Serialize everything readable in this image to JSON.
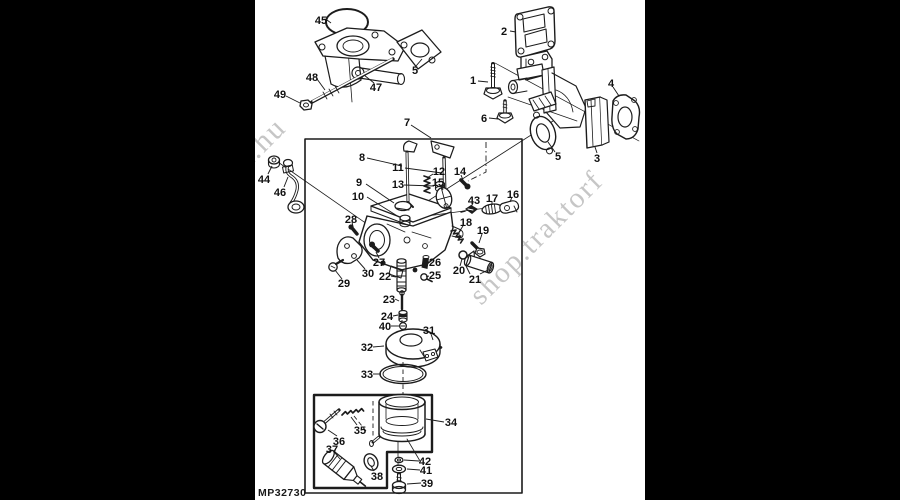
{
  "colors": {
    "letterbox": "#000000",
    "paper": "#ffffff",
    "ink": "#1c1c1c",
    "watermark": "#c6c6c6",
    "label_text": "#101010"
  },
  "footer": {
    "code": "MP32730"
  },
  "watermarks": [
    {
      "text": "k.hu",
      "x": -10,
      "y": 172,
      "rotate": -45,
      "size": 30
    },
    {
      "text": "shop.traktorf",
      "x": 226,
      "y": 306,
      "rotate": -45,
      "size": 29
    }
  ],
  "diagram": {
    "kind": "exploded-parts-diagram",
    "subject": "carburetor and intake manifold",
    "parts": [
      {
        "id": "45",
        "label": "45",
        "x": 66,
        "y": 20,
        "leaders": [
          [
            72,
            20,
            76,
            23
          ]
        ]
      },
      {
        "id": "48",
        "label": "48",
        "x": 57,
        "y": 77,
        "leaders": [
          [
            62,
            79,
            70,
            90
          ]
        ]
      },
      {
        "id": "49",
        "label": "49",
        "x": 25,
        "y": 94,
        "leaders": [
          [
            31,
            96,
            45,
            103
          ]
        ]
      },
      {
        "id": "47",
        "label": "47",
        "x": 121,
        "y": 87,
        "leaders": [
          [
            119,
            83,
            109,
            75
          ]
        ]
      },
      {
        "id": "5a",
        "label": "5",
        "x": 160,
        "y": 70,
        "leaders": [
          [
            161,
            66,
            167,
            59
          ]
        ]
      },
      {
        "id": "7",
        "label": "7",
        "x": 152,
        "y": 122,
        "leaders": [
          [
            156,
            125,
            176,
            138
          ]
        ]
      },
      {
        "id": "2",
        "label": "2",
        "x": 249,
        "y": 31,
        "leaders": [
          [
            255,
            31,
            261,
            32
          ]
        ]
      },
      {
        "id": "1",
        "label": "1",
        "x": 218,
        "y": 80,
        "leaders": [
          [
            223,
            81,
            233,
            82
          ]
        ]
      },
      {
        "id": "6",
        "label": "6",
        "x": 229,
        "y": 118,
        "leaders": [
          [
            234,
            118,
            243,
            119
          ]
        ]
      },
      {
        "id": "5b",
        "label": "5",
        "x": 303,
        "y": 156,
        "leaders": [
          [
            300,
            152,
            293,
            142
          ]
        ]
      },
      {
        "id": "3",
        "label": "3",
        "x": 342,
        "y": 158,
        "leaders": [
          [
            342,
            153,
            340,
            147
          ]
        ]
      },
      {
        "id": "4",
        "label": "4",
        "x": 356,
        "y": 83,
        "leaders": [
          [
            358,
            87,
            364,
            96
          ]
        ]
      },
      {
        "id": "44",
        "label": "44",
        "x": 9,
        "y": 179,
        "leaders": [
          [
            13,
            174,
            17,
            166
          ]
        ]
      },
      {
        "id": "46",
        "label": "46",
        "x": 25,
        "y": 192,
        "leaders": [
          [
            29,
            187,
            33,
            177
          ]
        ]
      },
      {
        "id": "8",
        "label": "8",
        "x": 107,
        "y": 157,
        "leaders": [
          [
            112,
            158,
            147,
            166
          ]
        ]
      },
      {
        "id": "9",
        "label": "9",
        "x": 104,
        "y": 182,
        "leaders": [
          [
            111,
            184,
            139,
            203
          ]
        ]
      },
      {
        "id": "10",
        "label": "10",
        "x": 103,
        "y": 196,
        "leaders": [
          [
            112,
            197,
            144,
            217
          ]
        ]
      },
      {
        "id": "11",
        "label": "11",
        "x": 143,
        "y": 167,
        "leaders": [
          [
            150,
            168,
            187,
            173
          ]
        ]
      },
      {
        "id": "13",
        "label": "13",
        "x": 143,
        "y": 184,
        "leaders": [
          [
            149,
            185,
            179,
            186
          ]
        ]
      },
      {
        "id": "12",
        "label": "12",
        "x": 184,
        "y": 171,
        "leaders": [
          [
            178,
            174,
            172,
            178
          ]
        ]
      },
      {
        "id": "14",
        "label": "14",
        "x": 205,
        "y": 171,
        "leaders": [
          [
            206,
            175,
            208,
            180
          ]
        ]
      },
      {
        "id": "15",
        "label": "15",
        "x": 183,
        "y": 182,
        "leaders": [
          [
            186,
            186,
            188,
            190
          ]
        ]
      },
      {
        "id": "43",
        "label": "43",
        "x": 219,
        "y": 200,
        "leaders": [
          [
            218,
            203,
            216,
            207
          ]
        ]
      },
      {
        "id": "17",
        "label": "17",
        "x": 237,
        "y": 198,
        "leaders": [
          [
            237,
            201,
            237,
            205
          ]
        ]
      },
      {
        "id": "16",
        "label": "16",
        "x": 258,
        "y": 194,
        "leaders": [
          [
            257,
            197,
            255,
            202
          ]
        ]
      },
      {
        "id": "28",
        "label": "28",
        "x": 96,
        "y": 219,
        "leaders": [
          [
            97,
            222,
            98,
            227
          ]
        ]
      },
      {
        "id": "27",
        "label": "27",
        "x": 124,
        "y": 262,
        "leaders": [
          [
            124,
            258,
            121,
            252
          ]
        ]
      },
      {
        "id": "30",
        "label": "30",
        "x": 113,
        "y": 273,
        "leaders": [
          [
            110,
            269,
            102,
            260
          ]
        ]
      },
      {
        "id": "29",
        "label": "29",
        "x": 89,
        "y": 283,
        "leaders": [
          [
            87,
            279,
            80,
            270
          ]
        ]
      },
      {
        "id": "22",
        "label": "22",
        "x": 130,
        "y": 276,
        "leaders": [
          [
            136,
            276,
            141,
            277
          ]
        ]
      },
      {
        "id": "26",
        "label": "26",
        "x": 180,
        "y": 262,
        "leaders": [
          [
            174,
            262,
            168,
            261
          ]
        ]
      },
      {
        "id": "25",
        "label": "25",
        "x": 180,
        "y": 275,
        "leaders": [
          [
            174,
            276,
            171,
            277
          ]
        ]
      },
      {
        "id": "18",
        "label": "18",
        "x": 211,
        "y": 222,
        "leaders": [
          [
            208,
            226,
            204,
            232
          ]
        ]
      },
      {
        "id": "19",
        "label": "19",
        "x": 228,
        "y": 230,
        "leaders": [
          [
            227,
            234,
            224,
            243
          ]
        ]
      },
      {
        "id": "20",
        "label": "20",
        "x": 204,
        "y": 270,
        "leaders": [
          [
            205,
            266,
            207,
            259
          ]
        ]
      },
      {
        "id": "21",
        "label": "21",
        "x": 220,
        "y": 279,
        "leaders": [
          [
            215,
            274,
            211,
            266
          ],
          [
            225,
            274,
            233,
            270
          ]
        ]
      },
      {
        "id": "23",
        "label": "23",
        "x": 134,
        "y": 299,
        "leaders": [
          [
            140,
            299,
            144,
            301
          ]
        ]
      },
      {
        "id": "24",
        "label": "24",
        "x": 132,
        "y": 316,
        "leaders": [
          [
            138,
            316,
            143,
            315
          ]
        ]
      },
      {
        "id": "40",
        "label": "40",
        "x": 130,
        "y": 326,
        "leaders": [
          [
            136,
            326,
            144,
            326
          ]
        ]
      },
      {
        "id": "31",
        "label": "31",
        "x": 174,
        "y": 330,
        "leaders": [
          [
            176,
            334,
            178,
            340
          ]
        ]
      },
      {
        "id": "32",
        "label": "32",
        "x": 112,
        "y": 347,
        "leaders": [
          [
            118,
            347,
            129,
            346
          ]
        ]
      },
      {
        "id": "33",
        "label": "33",
        "x": 112,
        "y": 374,
        "leaders": [
          [
            118,
            374,
            126,
            374
          ]
        ]
      },
      {
        "id": "34",
        "label": "34",
        "x": 196,
        "y": 422,
        "leaders": [
          [
            189,
            422,
            171,
            419
          ]
        ]
      },
      {
        "id": "35",
        "label": "35",
        "x": 105,
        "y": 430,
        "leaders": [
          [
            102,
            425,
            96,
            417
          ]
        ]
      },
      {
        "id": "36",
        "label": "36",
        "x": 84,
        "y": 441,
        "leaders": [
          [
            82,
            436,
            73,
            430
          ]
        ]
      },
      {
        "id": "37",
        "label": "37",
        "x": 77,
        "y": 449,
        "leaders": [
          [
            80,
            453,
            85,
            459
          ]
        ]
      },
      {
        "id": "38",
        "label": "38",
        "x": 122,
        "y": 476,
        "leaders": [
          [
            119,
            471,
            116,
            466
          ]
        ]
      },
      {
        "id": "42",
        "label": "42",
        "x": 170,
        "y": 461,
        "leaders": [
          [
            164,
            461,
            149,
            460
          ]
        ]
      },
      {
        "id": "41",
        "label": "41",
        "x": 171,
        "y": 470,
        "leaders": [
          [
            165,
            470,
            152,
            469
          ]
        ]
      },
      {
        "id": "39",
        "label": "39",
        "x": 172,
        "y": 483,
        "leaders": [
          [
            166,
            483,
            152,
            484
          ]
        ]
      }
    ]
  }
}
